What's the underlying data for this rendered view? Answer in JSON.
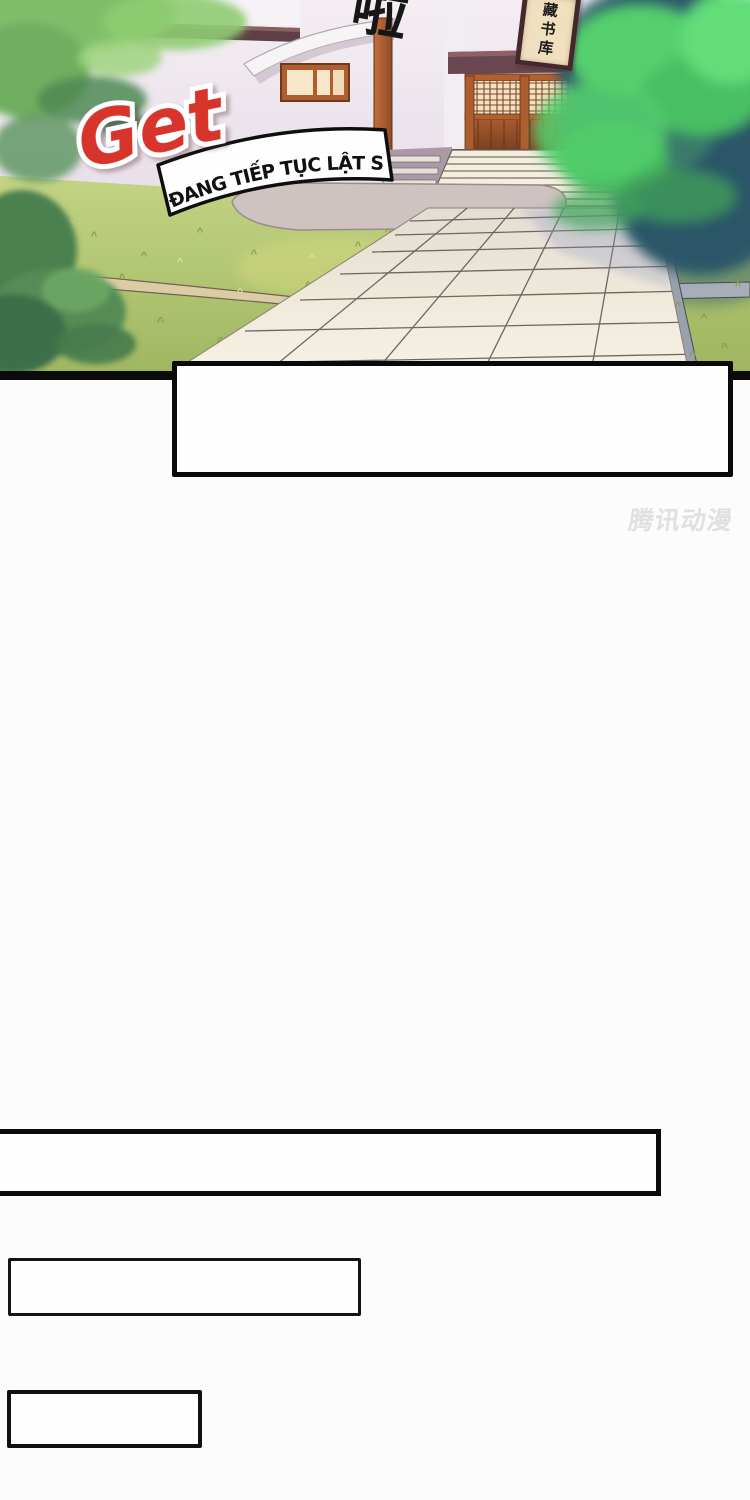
{
  "page": {
    "width": 750,
    "height": 1500,
    "background": "#fcfcfc"
  },
  "comic_panel": {
    "sound_effect_text": "啦",
    "library_sign": {
      "text": "藏书库",
      "face_color": "#f1e0c0",
      "frame_color": "#43292e"
    },
    "logo": {
      "text": "Get",
      "fill": "#d7342b",
      "outline": "#ffffff"
    },
    "caption_banner": {
      "text": "ĐANG TIẾP TỤC LẬT SÁCH....",
      "text_color": "#111111",
      "background": "#fefefe",
      "border_color": "#0e0e0e"
    },
    "palette": {
      "wall_light": "#f4eef3",
      "wall_shadow": "#d9cedc",
      "beam_dark": "#5e3f46",
      "wood_orange": "#b2602f",
      "wood_dark": "#7e421f",
      "lintel": "#6a474e",
      "lattice_cream": "#f3e3c4",
      "stairs": "#f4eedf",
      "tile": "#efe9da",
      "tile_line": "#6f675e",
      "grass_light": "#c3d484",
      "grass_dark": "#9fb660",
      "bush_dark": "#4c8050",
      "tree_bright": "#54cf6d",
      "tree_shadow": "#2e5a6c",
      "curb_gray": "#9aa0ac",
      "platform_gray": "#cec3c1",
      "path_strip_tan": "#dccca6",
      "panel_line": "#0b0b0b"
    }
  },
  "speech_box": {
    "text": ""
  },
  "watermark": {
    "text": "腾讯动漫",
    "color": "#e2dfe2"
  },
  "empty_panels": {
    "wide": {
      "text": ""
    },
    "medium": {
      "text": ""
    },
    "small": {
      "text": ""
    }
  }
}
